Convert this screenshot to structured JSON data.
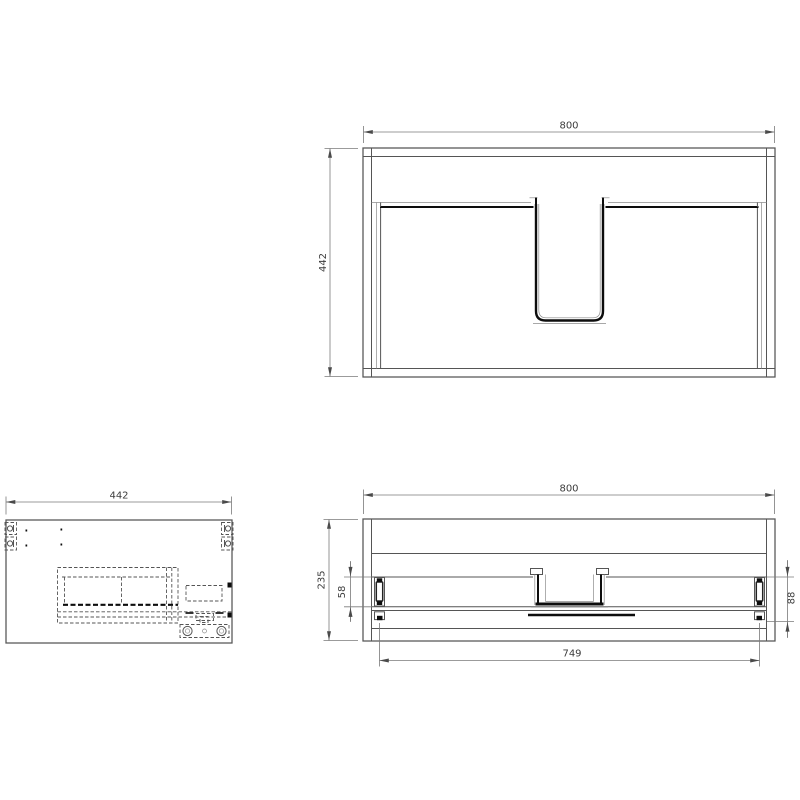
{
  "drawing": {
    "dims": {
      "plan_width": "800",
      "plan_depth": "442",
      "side_depth": "442",
      "front_width": "800",
      "front_height": "235",
      "front_left_offset": "58",
      "front_right_offset": "88",
      "front_span": "749"
    },
    "colors": {
      "bg": "#ffffff",
      "line": "#555555",
      "thin": "#8b8b8b",
      "thick": "#0d0d0d",
      "dim": "#7a7a7a",
      "dim-arrow": "#4a4a4a",
      "text": "#3c3c3c"
    }
  }
}
